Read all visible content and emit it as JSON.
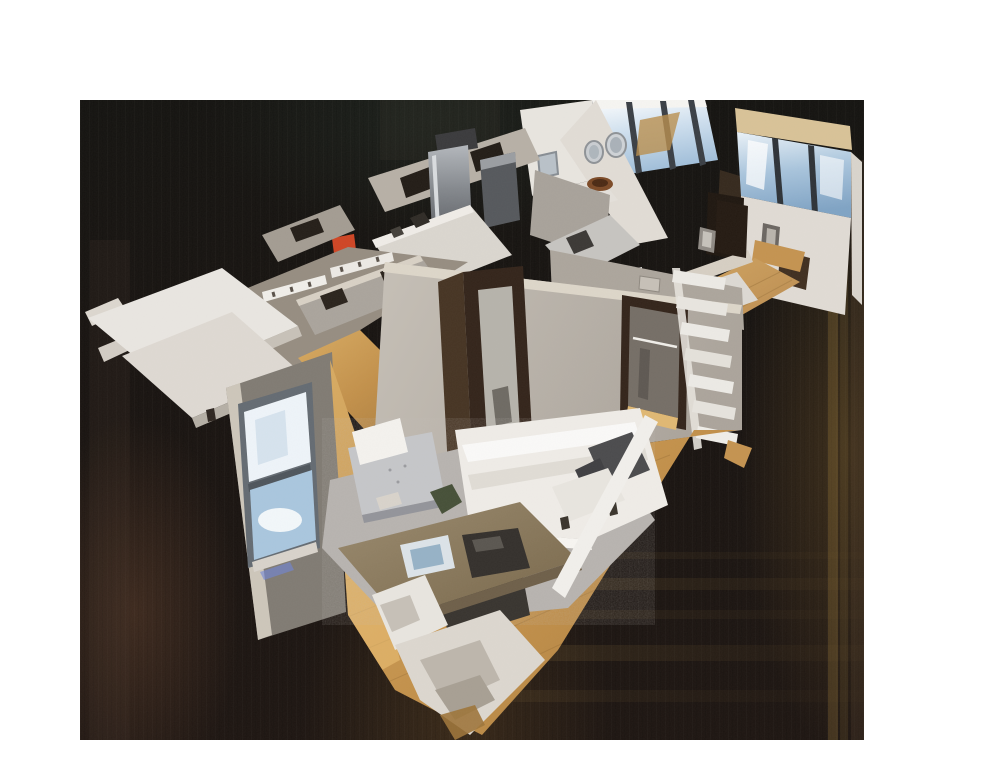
{
  "viewer": {
    "kind": "3d-dollhouse-scan-view",
    "description": "Top-down angled dollhouse cutaway of a scanned apartment floating on a dark canvas with white page margins",
    "canvas": {
      "x": 80,
      "y": 100,
      "width": 784,
      "height": 640
    },
    "interaction_hint": "drag-to-orbit viewport"
  },
  "scene": {
    "rooms": [
      {
        "name": "bedroom",
        "furniture": [
          "bed-with-white-duvet",
          "dark-pillows",
          "gray-area-rug",
          "tufted-armchair-with-throw",
          "wood-desk",
          "white-desk-chair",
          "white-bench",
          "plant"
        ]
      },
      {
        "name": "bedroom-window-wall",
        "furniture": [
          "double-hung-window",
          "led-floor-glow"
        ]
      },
      {
        "name": "kitchen",
        "furniture": [
          "stainless-refrigerator",
          "range",
          "white-cabinets",
          "red-countertop-item",
          "steel-counter"
        ]
      },
      {
        "name": "hallway-bath",
        "furniture": [
          "marble-counter-sink",
          "hanging-towel",
          "closet-doorway",
          "white-ladder-shelf",
          "framed-picture"
        ]
      },
      {
        "name": "living-dining",
        "furniture": [
          "round-wall-mirrors",
          "square-mirror",
          "window-wall",
          "wood-bowl",
          "console"
        ]
      },
      {
        "name": "entry-closet-wing",
        "furniture": [
          "wall-hook-rails",
          "white-console-table",
          "white-bench-slab"
        ]
      }
    ]
  },
  "palette": {
    "page_bg": "#ffffff",
    "canvas_bg": "#17110e",
    "wall_light": "#e8e5df",
    "wall_mid": "#b7b0a7",
    "wall_taupe": "#968d81",
    "wall_dark": "#807b73",
    "wall_cut_top": "#ddd6c9",
    "wood_light": "#e0b873",
    "wood_mid": "#c49350",
    "wood_dark": "#9d743a",
    "rug_gray": "#b6b2ae",
    "bed_white": "#efece7",
    "pillow_dark": "#4b4b4d",
    "glass_bright": "#eef4f9",
    "glass_blue": "#a9c6de",
    "frame_dark": "#33241a",
    "steel_light": "#b0b4b9",
    "steel_dark": "#55585c",
    "soffit_tan": "#d8c297",
    "accent_red": "#cf4524",
    "smear_gold": "#a8812f",
    "led_blue": "#6f86d8"
  }
}
